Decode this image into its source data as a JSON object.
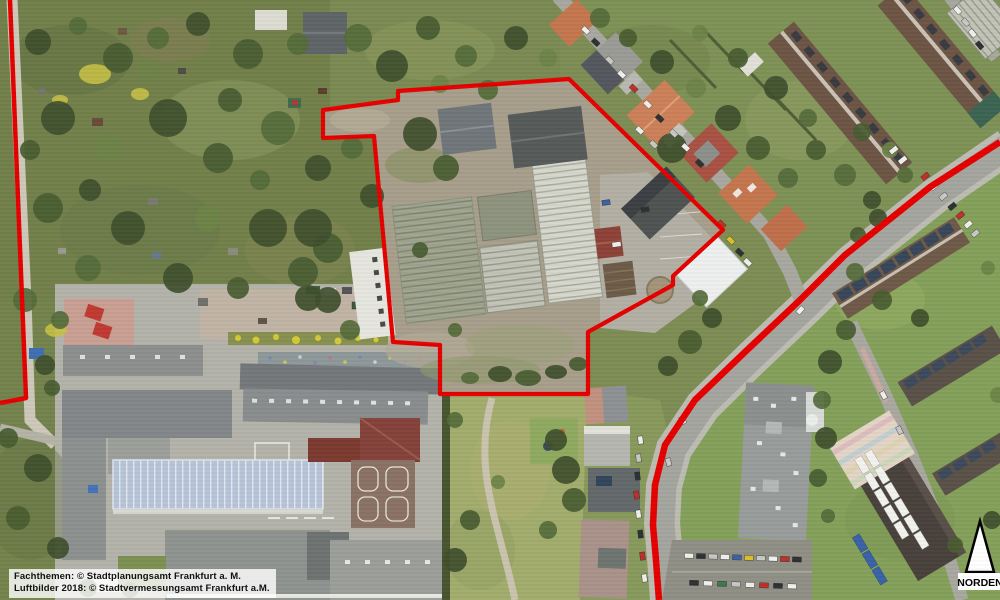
{
  "footer": {
    "line1": "Fachthemen: © Stadtplanungsamt Frankfurt a. M.",
    "line2": "Luftbilder 2018: © Stadtvermessungsamt Frankfurt a.M."
  },
  "compass": {
    "label": "NORDEN"
  },
  "colors": {
    "boundary_red": "#e60000"
  },
  "boundaries": {
    "site_polygon": "323,110 398,100 398,91 569,79 723,230 673,276 673,285 588,332 588,394 440,394 440,345 393,342 374,136 323,138",
    "west_line": "10,0 26,398 0,403",
    "road_line": "1000,142 930,187 845,255 800,300 745,352 695,400 665,445 655,485 653,525 656,560 659,600"
  }
}
